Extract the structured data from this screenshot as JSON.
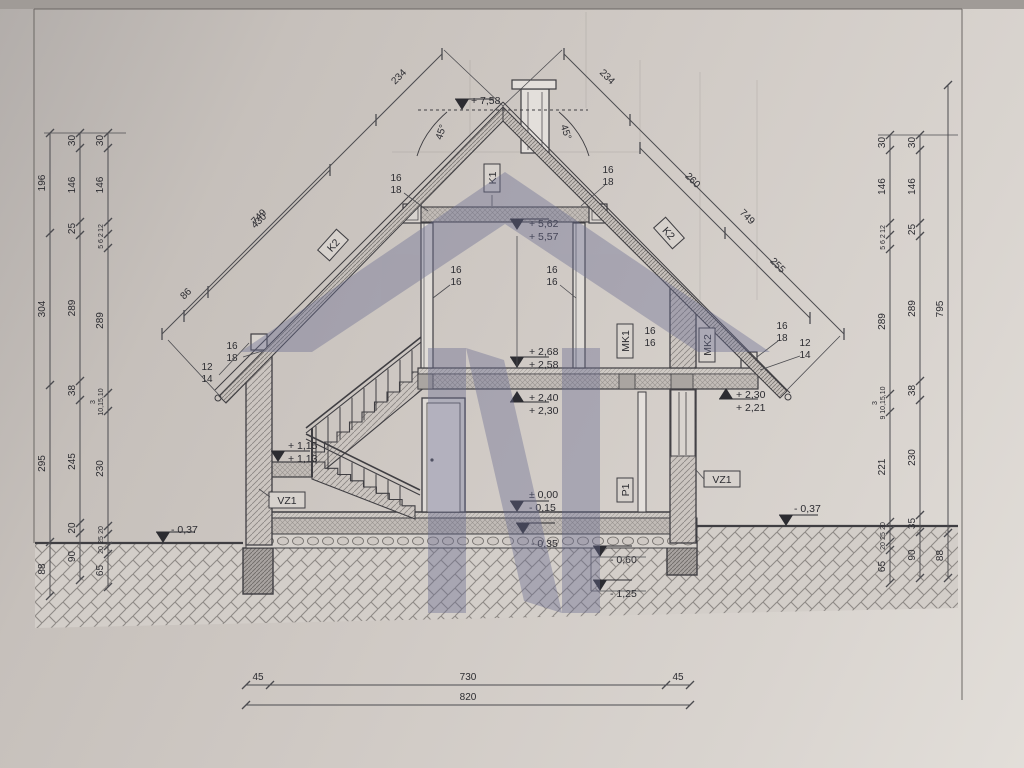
{
  "meta": {
    "title": "House cross-section technical drawing (side section with dimensions)"
  },
  "drawing": {
    "ink_color": "#3f3e42",
    "dim_color": "#4c4c50",
    "watermark": {
      "color": "#6a6c91",
      "opacity": 0.4
    },
    "vchains": [
      {
        "x": 50,
        "segs": [
          {
            "t": "196",
            "y1": 133,
            "y2": 233
          },
          {
            "t": "304",
            "y1": 233,
            "y2": 385
          },
          {
            "t": "295",
            "y1": 385,
            "y2": 542
          },
          {
            "t": "88",
            "y1": 542,
            "y2": 596
          }
        ]
      },
      {
        "x": 80,
        "segs": [
          {
            "t": "30",
            "y1": 133,
            "y2": 148
          },
          {
            "t": "146",
            "y1": 148,
            "y2": 222
          },
          {
            "t": "25",
            "y1": 222,
            "y2": 235
          },
          {
            "t": "289",
            "y1": 235,
            "y2": 381
          },
          {
            "t": "38",
            "y1": 381,
            "y2": 400
          },
          {
            "t": "245",
            "y1": 400,
            "y2": 523
          },
          {
            "t": "20",
            "y1": 523,
            "y2": 533
          },
          {
            "t": "90",
            "y1": 533,
            "y2": 580
          }
        ]
      },
      {
        "x": 108,
        "segs": [
          {
            "t": "30",
            "y1": 133,
            "y2": 148
          },
          {
            "t": "146",
            "y1": 148,
            "y2": 222
          },
          {
            "t": "12",
            "y1": 222,
            "y2": 234,
            "s": 7
          },
          {
            "t": "5 6 2",
            "y1": 234,
            "y2": 248,
            "s": 7
          },
          {
            "t": "289",
            "y1": 248,
            "y2": 393
          },
          {
            "t": "10,15,10",
            "y1": 393,
            "y2": 411,
            "s": 7
          },
          {
            "t": "230",
            "y1": 411,
            "y2": 526
          },
          {
            "t": "20",
            "y1": 526,
            "y2": 534,
            "s": 7
          },
          {
            "t": "25",
            "y1": 534,
            "y2": 546,
            "s": 7
          },
          {
            "t": "20",
            "y1": 546,
            "y2": 554,
            "s": 7
          },
          {
            "t": "65",
            "y1": 554,
            "y2": 587
          }
        ]
      },
      {
        "x": 890,
        "segs": [
          {
            "t": "30",
            "y1": 135,
            "y2": 150
          },
          {
            "t": "146",
            "y1": 150,
            "y2": 223
          },
          {
            "t": "12",
            "y1": 223,
            "y2": 235,
            "s": 7
          },
          {
            "t": "5 6 2",
            "y1": 235,
            "y2": 249,
            "s": 7
          },
          {
            "t": "289",
            "y1": 249,
            "y2": 394
          },
          {
            "t": "9 10,15,10",
            "y1": 394,
            "y2": 412,
            "s": 7
          },
          {
            "t": "221",
            "y1": 412,
            "y2": 522
          },
          {
            "t": "20",
            "y1": 522,
            "y2": 530,
            "s": 7
          },
          {
            "t": "25",
            "y1": 530,
            "y2": 542,
            "s": 7
          },
          {
            "t": "20",
            "y1": 542,
            "y2": 550,
            "s": 7
          },
          {
            "t": "65",
            "y1": 550,
            "y2": 583
          }
        ]
      },
      {
        "x": 920,
        "segs": [
          {
            "t": "30",
            "y1": 135,
            "y2": 150
          },
          {
            "t": "146",
            "y1": 150,
            "y2": 223
          },
          {
            "t": "25",
            "y1": 223,
            "y2": 236
          },
          {
            "t": "289",
            "y1": 236,
            "y2": 381
          },
          {
            "t": "38",
            "y1": 381,
            "y2": 400
          },
          {
            "t": "230",
            "y1": 400,
            "y2": 515
          },
          {
            "t": "35",
            "y1": 515,
            "y2": 532
          },
          {
            "t": "90",
            "y1": 532,
            "y2": 578
          }
        ]
      },
      {
        "x": 948,
        "segs": [
          {
            "t": "795",
            "y1": 85,
            "y2": 533
          },
          {
            "t": "88",
            "y1": 533,
            "y2": 578
          }
        ]
      }
    ],
    "dchains": [
      {
        "side": -1,
        "pts": [
          [
            442,
            54
          ],
          [
            376,
            120
          ],
          [
            162,
            334
          ]
        ],
        "labels": [
          {
            "t": "234",
            "i": 0
          },
          {
            "t": "749",
            "i": 1
          }
        ]
      },
      {
        "side": -1,
        "pts": [
          [
            330,
            170
          ],
          [
            208,
            292
          ],
          [
            184,
            316
          ]
        ],
        "labels": [
          {
            "t": "430",
            "i": 0
          },
          {
            "t": "86",
            "i": 1
          }
        ]
      },
      {
        "side": 1,
        "pts": [
          [
            564,
            54
          ],
          [
            630,
            120
          ],
          [
            844,
            334
          ]
        ],
        "labels": [
          {
            "t": "234",
            "i": 0
          },
          {
            "t": "749",
            "i": 1
          }
        ]
      },
      {
        "side": 1,
        "pts": [
          [
            640,
            148
          ],
          [
            725,
            233
          ],
          [
            810,
            318
          ]
        ],
        "labels": [
          {
            "t": "260",
            "i": 0
          },
          {
            "t": "255",
            "i": 1
          }
        ]
      }
    ],
    "hchains": [
      {
        "y": 685,
        "segs": [
          {
            "t": "45",
            "x1": 246,
            "x2": 270
          },
          {
            "t": "730",
            "x1": 270,
            "x2": 666
          },
          {
            "t": "45",
            "x1": 666,
            "x2": 690
          }
        ]
      },
      {
        "y": 705,
        "segs": [
          {
            "t": "820",
            "x1": 246,
            "x2": 690
          }
        ]
      }
    ],
    "levels": [
      {
        "t1": "+ 7,58",
        "x": 462,
        "y": 110,
        "dir": 1,
        "tx": 471,
        "ty": 104
      },
      {
        "t1": "+ 5,62",
        "t2": "+ 5,57",
        "x": 517,
        "y": 230,
        "dir": 1,
        "tx": 529,
        "ty": 227
      },
      {
        "t1": "+ 2,68",
        "t2": "+ 2,58",
        "x": 517,
        "y": 368,
        "dir": 1,
        "tx": 529,
        "ty": 355
      },
      {
        "t1": "+ 2,40",
        "t2": "+ 2,30",
        "x": 517,
        "y": 391,
        "dir": -1,
        "tx": 529,
        "ty": 401
      },
      {
        "t1": "+ 2,30",
        "t2": "+ 2,21",
        "x": 726,
        "y": 388,
        "dir": -1,
        "tx": 736,
        "ty": 398
      },
      {
        "t1": "+ 1,15",
        "t2": "+ 1,13",
        "x": 278,
        "y": 462,
        "dir": 1,
        "tx": 288,
        "ty": 449
      },
      {
        "t1": "± 0,00",
        "t2": "- 0,15",
        "x": 517,
        "y": 512,
        "dir": 1,
        "tx": 529,
        "ty": 498
      },
      {
        "t1": "- 0,35",
        "x": 523,
        "y": 534,
        "dir": 1,
        "tx": 531,
        "ty": 547
      },
      {
        "t1": "- 0,60",
        "x": 600,
        "y": 557,
        "dir": 1,
        "tx": 610,
        "ty": 563
      },
      {
        "t1": "- 1,25",
        "x": 600,
        "y": 591,
        "dir": 1,
        "tx": 610,
        "ty": 597
      },
      {
        "t1": "- 0,37",
        "x": 163,
        "y": 543,
        "dir": 1,
        "tx": 171,
        "ty": 533
      },
      {
        "t1": "- 0,37",
        "x": 786,
        "y": 526,
        "dir": 1,
        "tx": 794,
        "ty": 512
      }
    ],
    "boxes": [
      {
        "t": "K1",
        "x": 492,
        "y": 178,
        "a": -90,
        "w": 28
      },
      {
        "t": "K2",
        "x": 333,
        "y": 245,
        "a": -48,
        "w": 28
      },
      {
        "t": "K2",
        "x": 669,
        "y": 233,
        "a": 48,
        "w": 28
      },
      {
        "t": "MK1",
        "x": 625,
        "y": 341,
        "a": -90,
        "w": 34
      },
      {
        "t": "MK2",
        "x": 707,
        "y": 345,
        "a": -90,
        "w": 34
      },
      {
        "t": "P1",
        "x": 625,
        "y": 490,
        "a": -90,
        "w": 24
      },
      {
        "t": "VZ1",
        "x": 287,
        "y": 500,
        "a": 0,
        "w": 36
      },
      {
        "t": "VZ1",
        "x": 722,
        "y": 479,
        "a": 0,
        "w": 36
      }
    ],
    "fracs": [
      {
        "a": "16",
        "b": "18",
        "x": 396,
        "y": 181
      },
      {
        "a": "16",
        "b": "18",
        "x": 608,
        "y": 173
      },
      {
        "a": "16",
        "b": "16",
        "x": 456,
        "y": 273
      },
      {
        "a": "16",
        "b": "16",
        "x": 552,
        "y": 273
      },
      {
        "a": "16",
        "b": "16",
        "x": 650,
        "y": 334
      },
      {
        "a": "16",
        "b": "18",
        "x": 232,
        "y": 349
      },
      {
        "a": "12",
        "b": "14",
        "x": 207,
        "y": 370
      },
      {
        "a": "16",
        "b": "18",
        "x": 782,
        "y": 329
      },
      {
        "a": "12",
        "b": "14",
        "x": 805,
        "y": 346
      }
    ],
    "extra_texts": [
      {
        "t": "3",
        "x": 95,
        "y": 402,
        "s": 7,
        "a": -90
      },
      {
        "t": "3",
        "x": 877,
        "y": 403,
        "s": 7,
        "a": -90
      },
      {
        "t": "45°",
        "x": 444,
        "y": 133,
        "s": 10,
        "a": -72
      },
      {
        "t": "45°",
        "x": 563,
        "y": 133,
        "s": 10,
        "a": 72
      }
    ],
    "leaders": [
      [
        404,
        193,
        428,
        211
      ],
      [
        605,
        185,
        581,
        206
      ],
      [
        450,
        285,
        433,
        298
      ],
      [
        560,
        285,
        576,
        298
      ],
      [
        243,
        357,
        262,
        351
      ],
      [
        219,
        375,
        249,
        343
      ],
      [
        778,
        341,
        757,
        357
      ],
      [
        800,
        356,
        760,
        370
      ],
      [
        517,
        236,
        517,
        366
      ],
      [
        591,
        548,
        591,
        591
      ],
      [
        591,
        557,
        646,
        557
      ],
      [
        591,
        591,
        646,
        591
      ],
      [
        270,
        497,
        259,
        489
      ],
      [
        704,
        479,
        696,
        470
      ],
      [
        492,
        195,
        492,
        206
      ],
      [
        44,
        133,
        126,
        133
      ],
      [
        878,
        135,
        958,
        135
      ],
      [
        503,
        106,
        444,
        50
      ],
      [
        503,
        106,
        562,
        50
      ],
      [
        219,
        395,
        168,
        340
      ],
      [
        787,
        390,
        840,
        336
      ]
    ]
  }
}
